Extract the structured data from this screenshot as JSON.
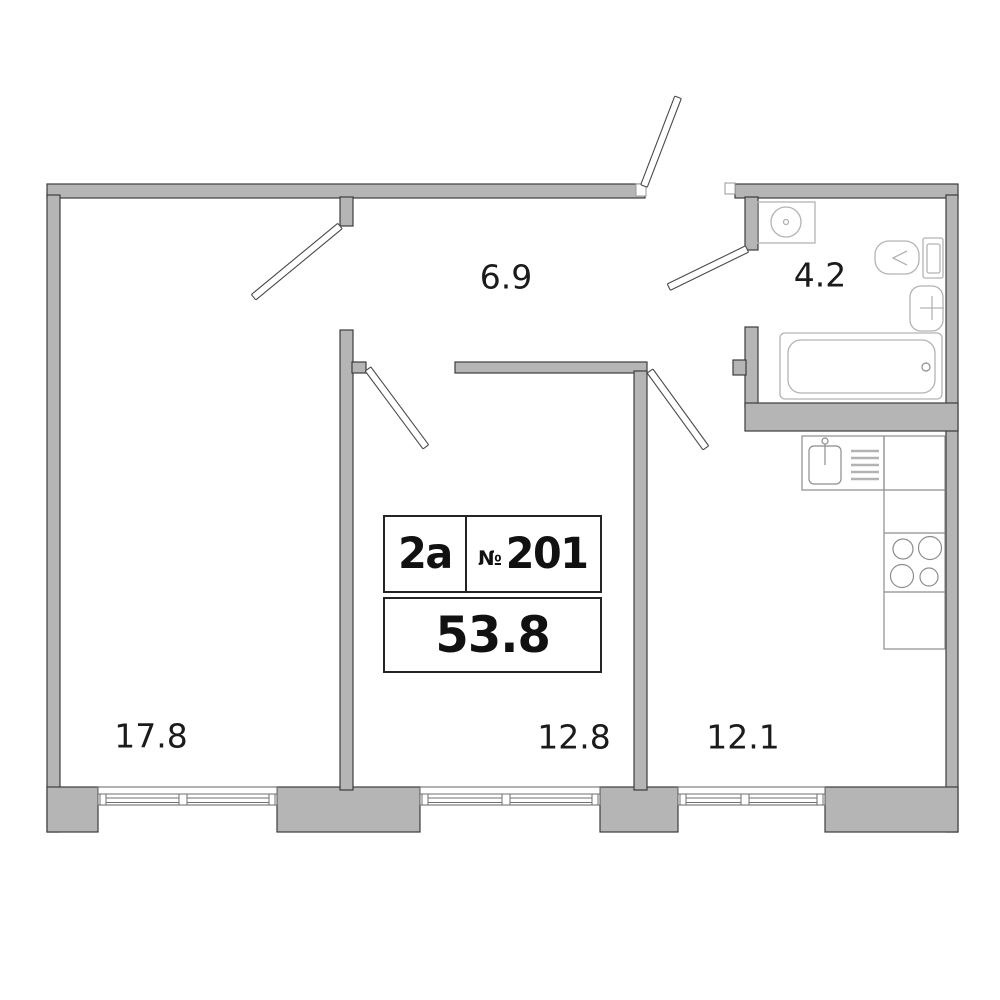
{
  "plan": {
    "unit": {
      "type_label": "2a",
      "number_sign": "№",
      "number": "201",
      "total_area": "53.8"
    },
    "rooms": {
      "living": {
        "area": "17.8"
      },
      "hall": {
        "area": "6.9"
      },
      "bedroom": {
        "area": "12.8"
      },
      "kitchen": {
        "area": "12.1"
      },
      "bathroom": {
        "area": "4.2"
      }
    },
    "colors": {
      "wall_fill": "#b5b5b5",
      "wall_outline": "#3d3d3d",
      "fixture_stroke": "#b3b3b3",
      "window_stroke": "#6f6f6f",
      "door_stroke": "#4a4a4a",
      "label_text": "#1b1b1b",
      "background": "#ffffff"
    }
  }
}
